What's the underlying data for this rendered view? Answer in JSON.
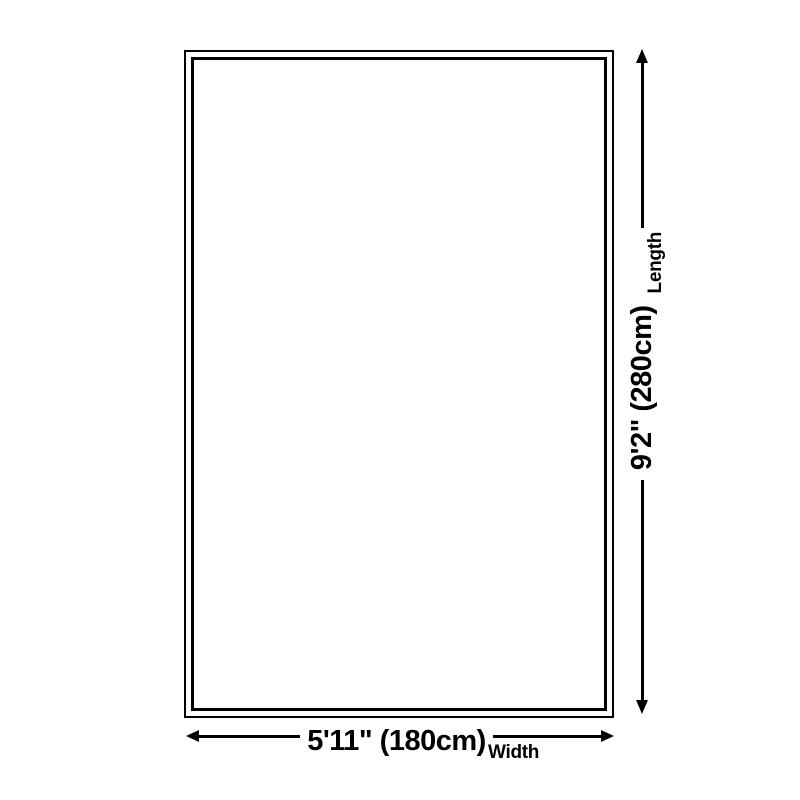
{
  "page": {
    "background_color": "#ffffff",
    "ink_color": "#000000",
    "kind": "rug-size-dimension-diagram"
  },
  "diagram": {
    "shape": "rectangle-double-border",
    "length": {
      "value": "9'2\" (280cm)",
      "label": "Length"
    },
    "width": {
      "value": "5'11\" (180cm)",
      "label": "Width"
    }
  }
}
